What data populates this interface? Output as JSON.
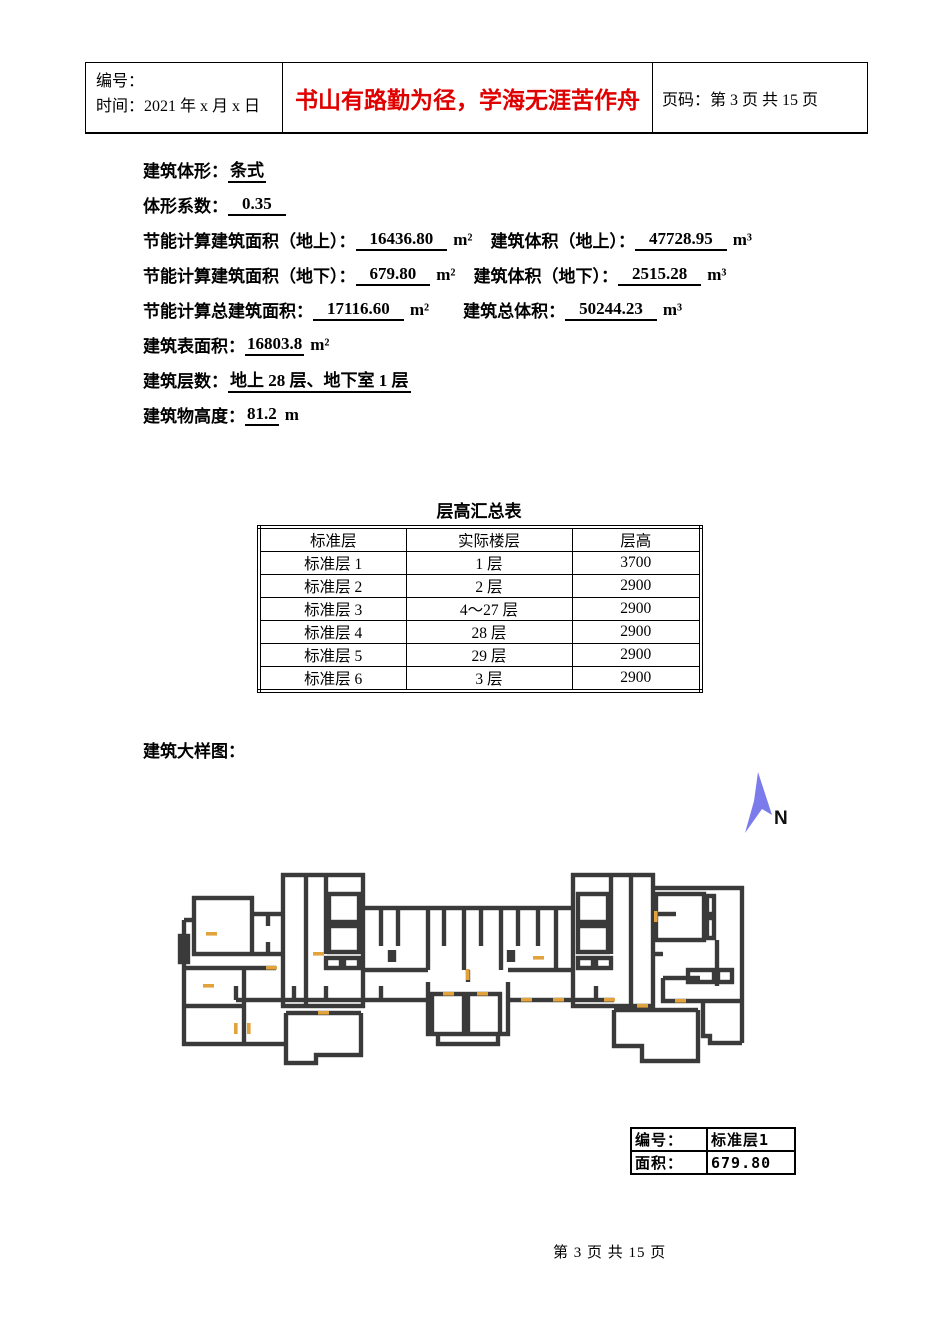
{
  "header": {
    "number_label": "编号：",
    "time_label": "时间：2021 年 x 月 x 日",
    "slogan": "书山有路勤为径，学海无涯苦作舟",
    "slogan_color": "#e00000",
    "page_info": "页码：第 3 页 共 15 页"
  },
  "info": {
    "shape": {
      "label": "建筑体形：",
      "value": "条式"
    },
    "coefficient": {
      "label": "体形系数：",
      "value": "0.35"
    },
    "area_above": {
      "label": "节能计算建筑面积（地上）：",
      "value": "16436.80",
      "unit": "m²"
    },
    "volume_above": {
      "label": "建筑体积（地上）：",
      "value": "47728.95",
      "unit": "m³"
    },
    "area_below": {
      "label": "节能计算建筑面积（地下）：",
      "value": "679.80",
      "unit": "m²"
    },
    "volume_below": {
      "label": "建筑体积（地下）：",
      "value": "2515.28",
      "unit": "m³"
    },
    "area_total": {
      "label": "节能计算总建筑面积：",
      "value": "17116.60",
      "unit": "m²"
    },
    "volume_total": {
      "label": "建筑总体积：",
      "value": "50244.23",
      "unit": "m³"
    },
    "surface_area": {
      "label": "建筑表面积：",
      "value": "16803.8",
      "unit": "m²"
    },
    "floors": {
      "label": "建筑层数：",
      "value": "地上 28 层、地下室 1 层"
    },
    "height": {
      "label": "建筑物高度：",
      "value": "81.2",
      "unit": "m"
    }
  },
  "floor_table": {
    "title": "层高汇总表",
    "headers": [
      "标准层",
      "实际楼层",
      "层高"
    ],
    "rows": [
      [
        "标准层 1",
        "1 层",
        "3700"
      ],
      [
        "标准层 2",
        "2 层",
        "2900"
      ],
      [
        "标准层 3",
        "4～27 层",
        "2900"
      ],
      [
        "标准层 4",
        "28 层",
        "2900"
      ],
      [
        "标准层 5",
        "29 层",
        "2900"
      ],
      [
        "标准层 6",
        "3 层",
        "2900"
      ]
    ]
  },
  "plan": {
    "label": "建筑大样图：",
    "north_label": "N",
    "north_color": "#7b7bec",
    "wall_color": "#3a3a3a",
    "door_color": "#e2a33c",
    "info_table": {
      "rows": [
        [
          "编号：",
          "标准层1"
        ],
        [
          "面积：",
          "679.80"
        ]
      ]
    }
  },
  "footer": {
    "page_text": "第 3 页 共 15 页"
  }
}
